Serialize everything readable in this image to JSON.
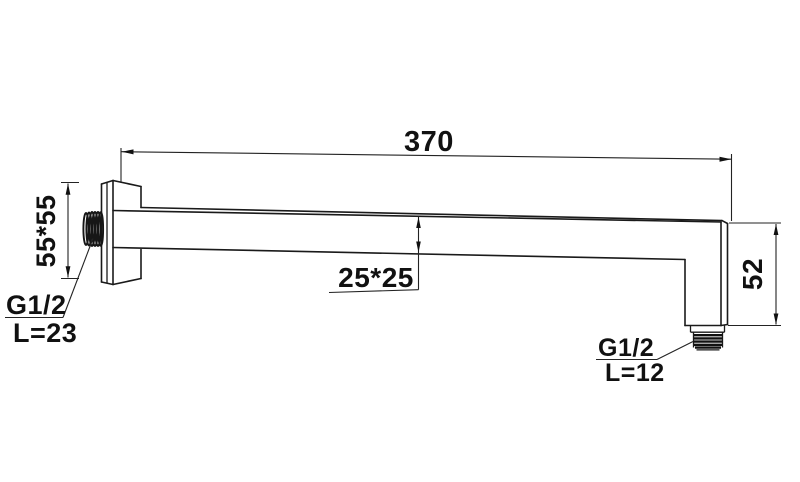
{
  "page": {
    "background": "#ffffff",
    "line_color": "#1a1a1a"
  },
  "drawing": {
    "description": "Technical dimension drawing of a wall-mounted square shower arm with threaded connections",
    "dims": {
      "arm_length": "370",
      "flange_size": "55*55",
      "tube_section": "25*25",
      "drop_height": "52",
      "wall_thread_size": "G1/2",
      "wall_thread_length": "L=23",
      "outlet_thread_size": "G1/2",
      "outlet_thread_length": "L=12"
    }
  }
}
